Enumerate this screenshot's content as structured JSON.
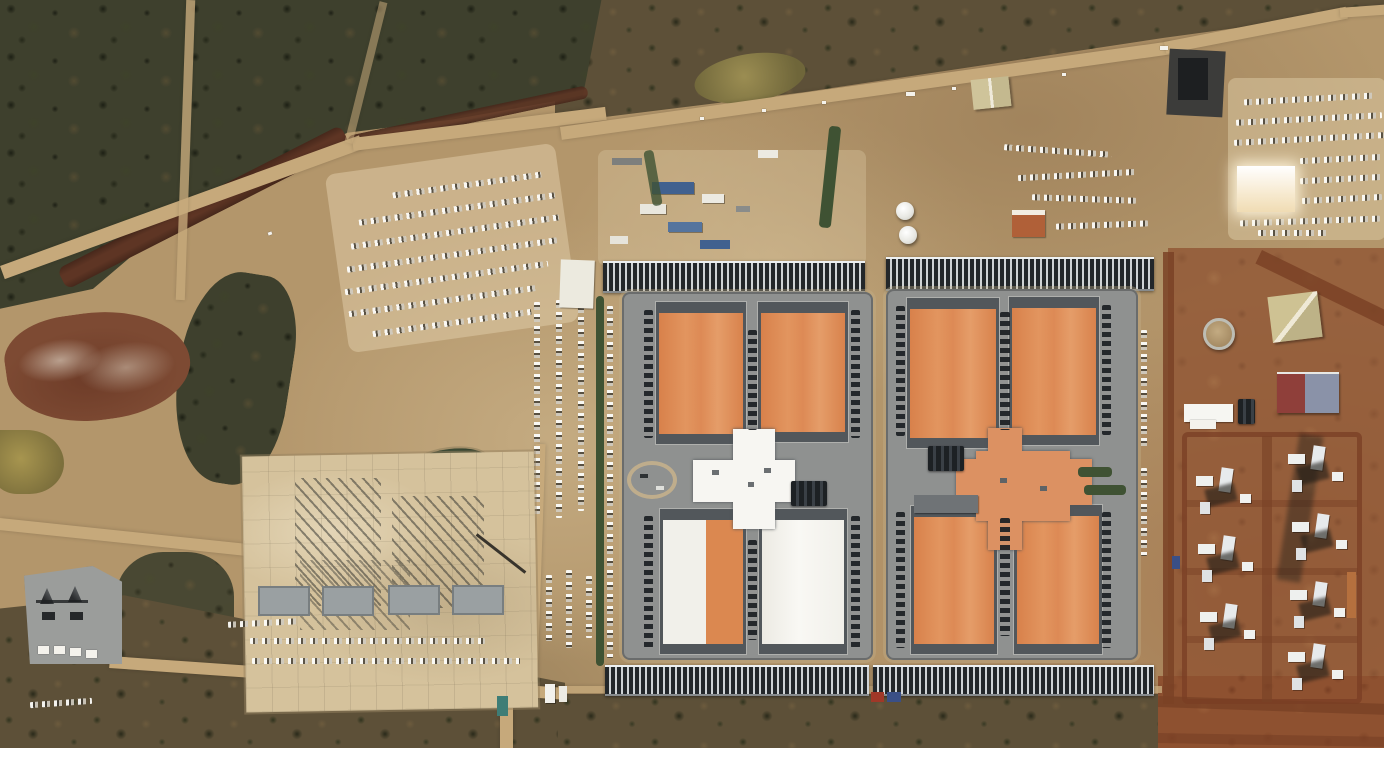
{
  "scene": {
    "type": "satellite-aerial-photograph",
    "subject": "large data center campus under construction on arid scrubland",
    "no_visible_text": true,
    "palette": {
      "dirt": "#b3966b",
      "dirtPale": "#d8c7a2",
      "scrubDark": "#3e402d",
      "scrubBrown": "#5d5038",
      "redSoil": "#8e5130",
      "redRoad": "#7a4226",
      "creek": "#5e3524",
      "roadTan": "#c6a97b",
      "apron": "#8f9190",
      "roofOrange": "#dc8b55",
      "roofOrangeLight": "#dc9162",
      "roofWhite": "#f4f3ef",
      "roofDark": "#52575b",
      "equipDark": "#23272a",
      "equipLight": "#cfd3d5",
      "padConcrete": "#d5c29c",
      "steelGray": "#9aa0a2",
      "water": "#3f5233",
      "pondOlive": "#8a7c46",
      "blueStack": "#41618f",
      "containerRed": "#a03828",
      "containerBlue": "#3a4f86",
      "substationGray": "#9b9d9b",
      "marginWhite": "#ffffff"
    }
  },
  "labels": {
    "stage": "satellite view of data center construction site",
    "vegetation": "dark scrub vegetation",
    "creek": "red-brown creek bed",
    "road": "dirt access road",
    "parkingWest": "employee parking lot (west)",
    "parkingNortheast": "parking lot (northeast)",
    "laydown": "construction laydown yard",
    "pond": "retention pond",
    "mound": "graded spoil mound",
    "constructionPad": "building pad under construction",
    "substation": "electrical substation",
    "datacenterWest": "data center building, west complex",
    "datacenterEast": "data center building, east complex",
    "hall": "data hall with orange roof",
    "hallWhite": "data hall with white roof",
    "cross": "central plant cross building",
    "equipRow": "row of electrical / cooling equipment",
    "camp": "equipment and trailer yard",
    "tanks": "white storage tanks",
    "warehouse": "warehouse building",
    "containers": "shipping containers"
  }
}
